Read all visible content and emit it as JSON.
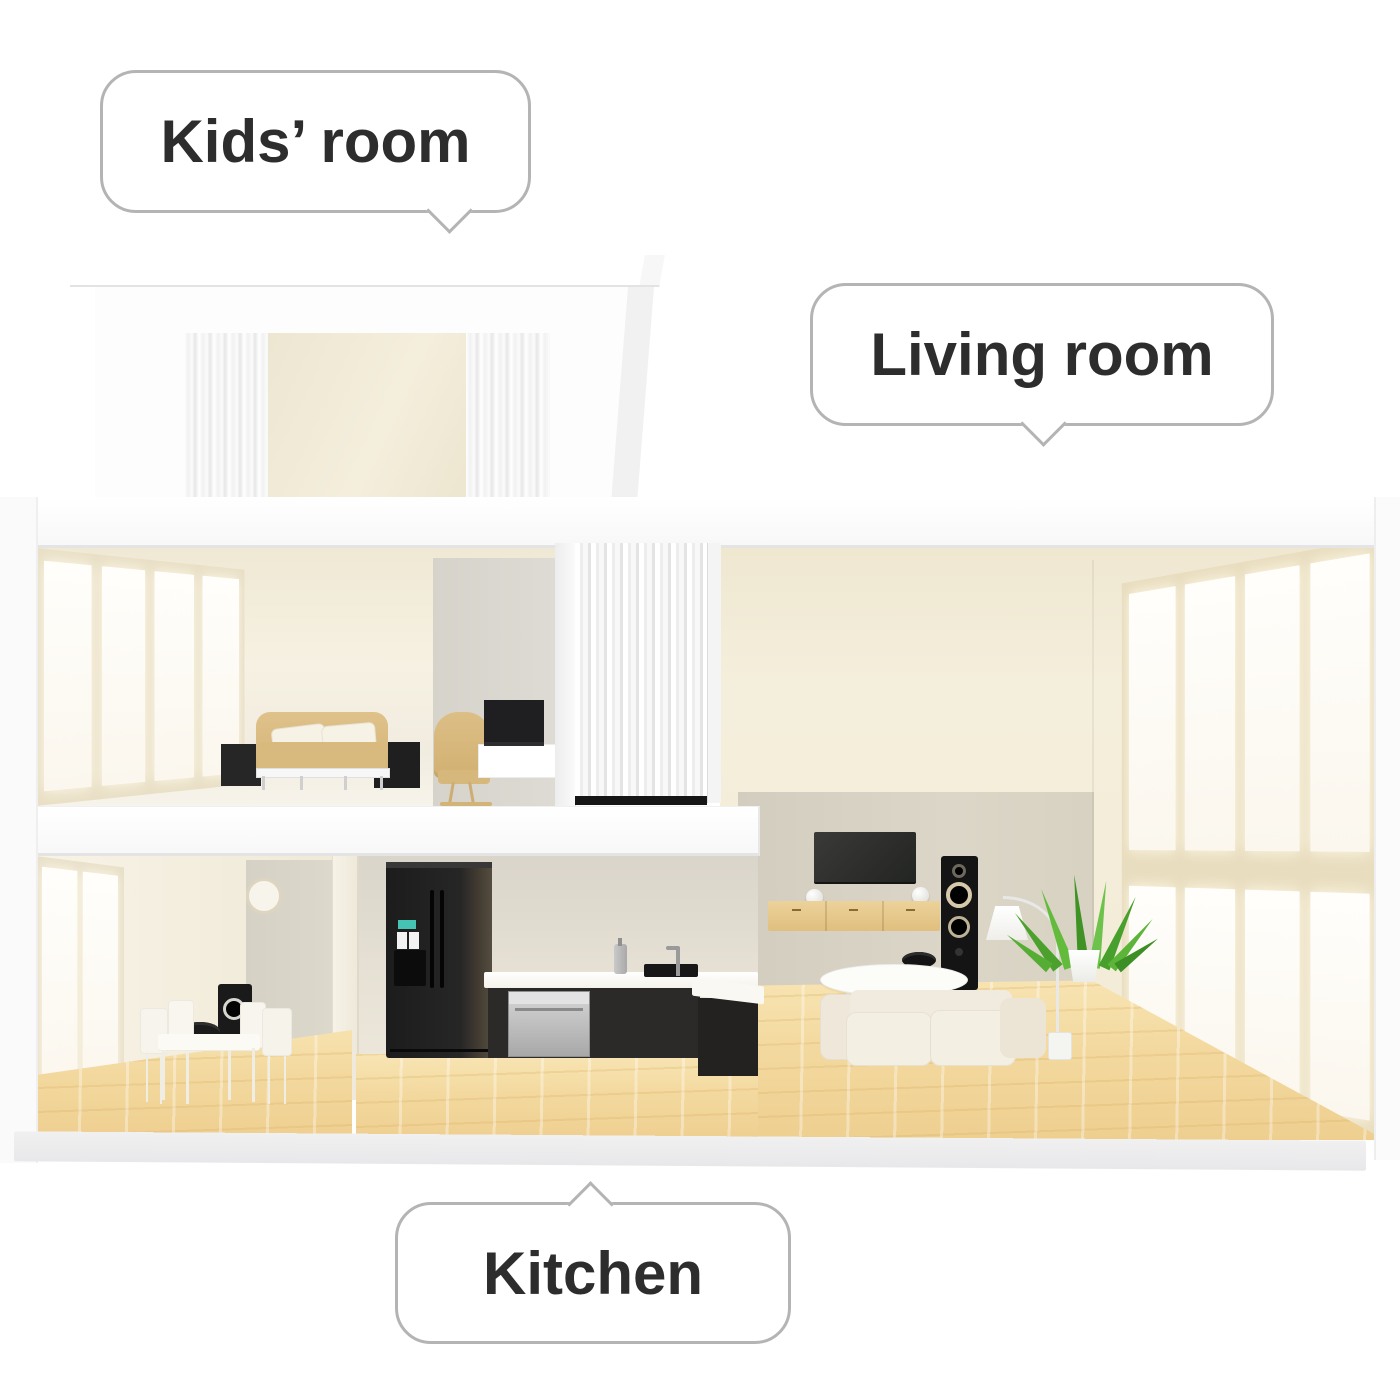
{
  "callouts": {
    "kids_room": {
      "label": "Kids’ room"
    },
    "living_room": {
      "label": "Living room"
    },
    "kitchen": {
      "label": "Kitchen"
    }
  },
  "palette": {
    "background": "#ffffff",
    "bubble_border": "#b4b4b4",
    "bubble_text": "#2d2d2d",
    "wall_cream": "#f3edda",
    "wall_taupe": "#d9d3c6",
    "wall_gray": "#dbd8d1",
    "window_mullion": "#ebe0c3",
    "wood_floor": "#f3d99f",
    "sofa_tan": "#d8b97e",
    "furniture_black": "#1f1f1f",
    "stainless": "#c0c0c0",
    "plant_green": "#4ca12c"
  }
}
